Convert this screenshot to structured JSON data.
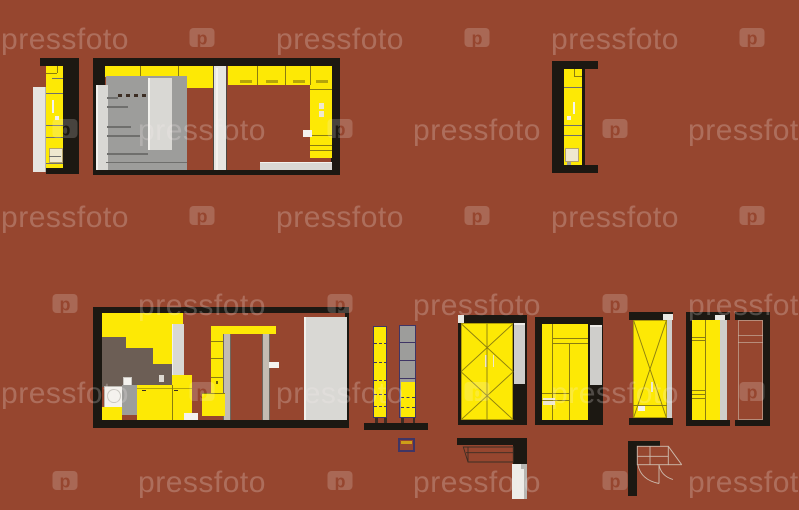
{
  "watermark": {
    "text": "pressfoto",
    "logo_letter": "p",
    "rows": [
      {
        "cy": 40,
        "start": "text"
      },
      {
        "cy": 131,
        "start": "logo"
      },
      {
        "cy": 218,
        "start": "text"
      },
      {
        "cy": 306,
        "start": "logo"
      },
      {
        "cy": 394,
        "start": "text"
      },
      {
        "cy": 483,
        "start": "logo"
      }
    ],
    "col_centers": [
      65,
      202,
      340,
      477,
      615,
      752
    ]
  },
  "palette": {
    "bg": "#96462f",
    "ink": "#1c1812",
    "yellow": "#fde905",
    "yellowLine": "#8a7d10",
    "yellowTick": "#b5a509",
    "taupe": "#6c5e55",
    "mgray": "#9d9d9b",
    "lgray": "#d9d8d4",
    "lgray2": "#e6e5e1",
    "wht": "#f4f2ee",
    "wht2": "#e8e7e3",
    "cream": "#efe8cf",
    "purple": "#3f3565",
    "jamb": "#c3bcb2",
    "glineDark": "#6f6f6d",
    "lnDark": "#3c2d23",
    "lnLite": "#cdbbae",
    "wmText": "rgba(245,240,238,0.24)",
    "wmFill": "rgba(245,242,240,0.20)"
  }
}
